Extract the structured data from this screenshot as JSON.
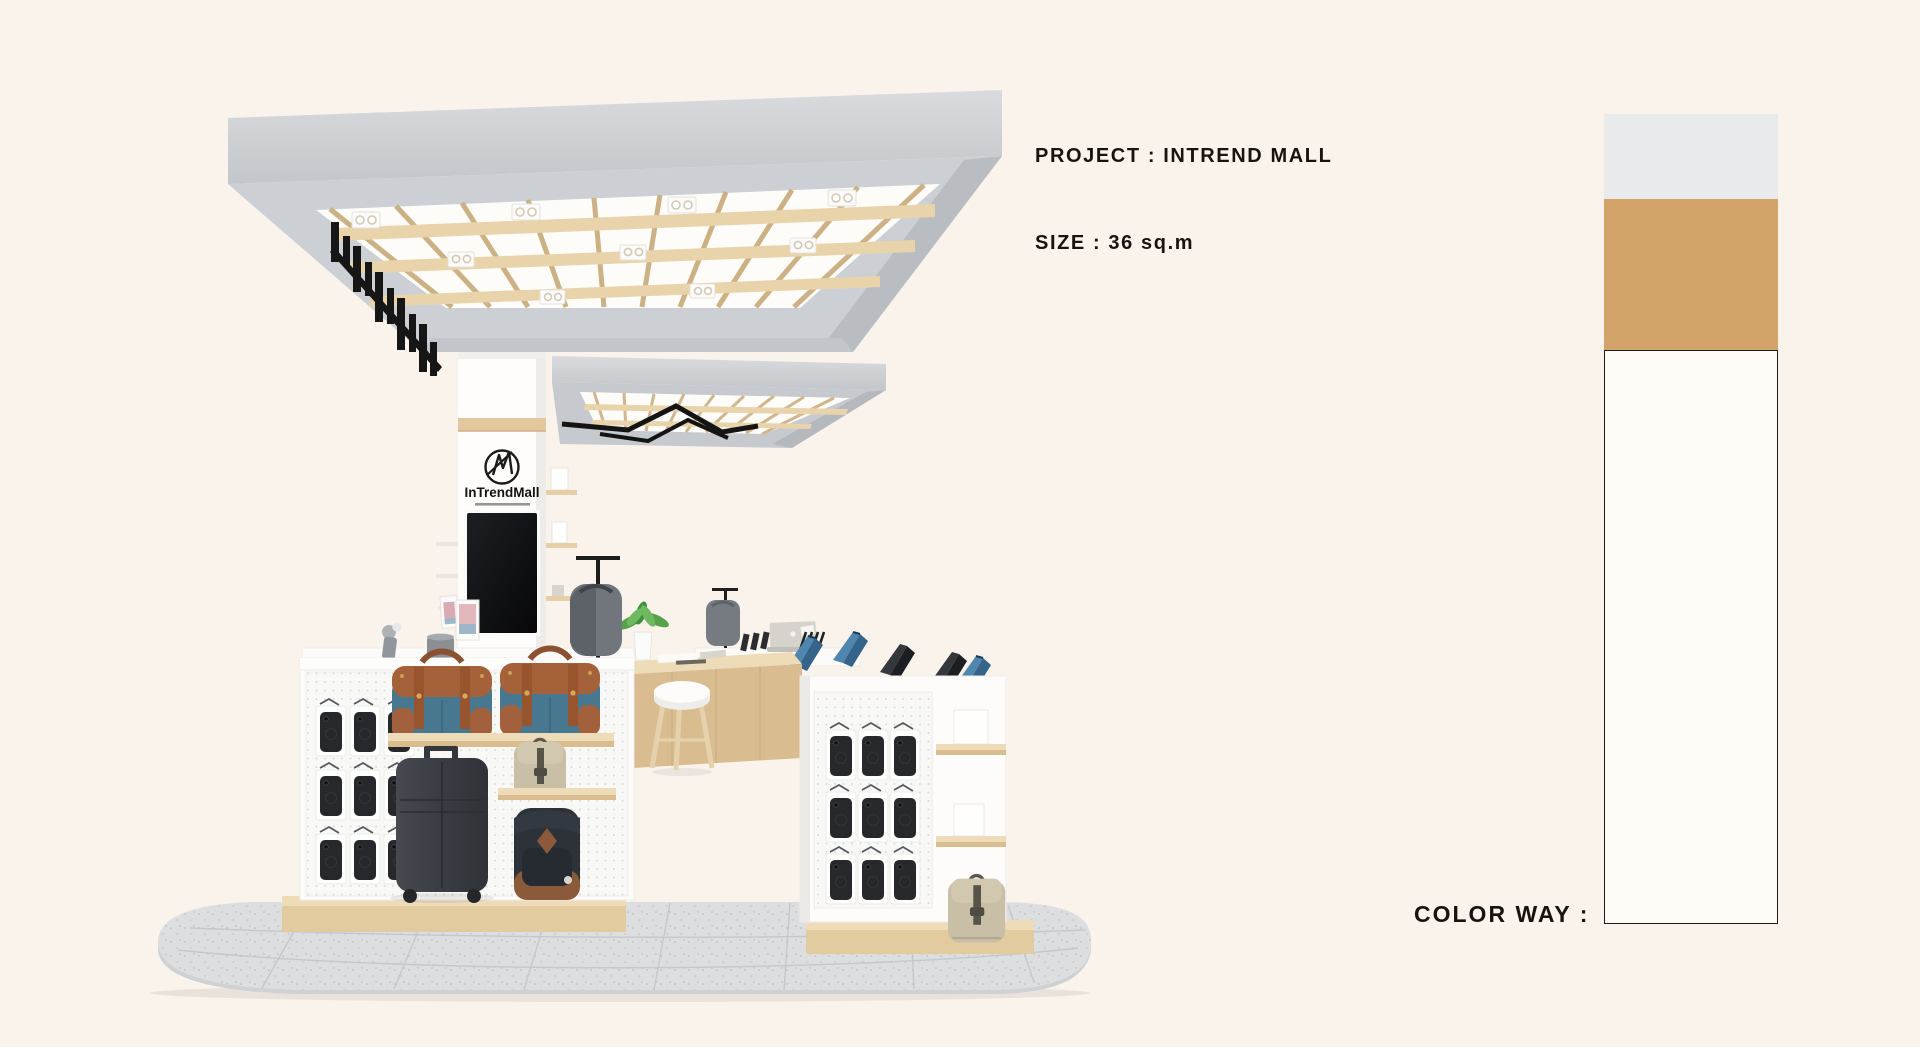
{
  "board": {
    "background": "#faf3ec",
    "text_color": "#17130f"
  },
  "annotations": {
    "project_label": "PROJECT : INTREND MALL",
    "size_label": "SIZE : 36 sq.m"
  },
  "color_way": {
    "label": "COLOR WAY :",
    "swatches": [
      {
        "name": "concrete-gray",
        "hex": "#e8eaec"
      },
      {
        "name": "camel-wood",
        "hex": "#d2a469"
      },
      {
        "name": "off-white",
        "hex": "#fffcf7"
      }
    ]
  },
  "kiosk": {
    "brand": "InTrendMall",
    "items": [
      "concrete-canopy-with-wood-slat-grid",
      "spotlight-fixtures",
      "hanging-black-sign",
      "secondary-canopy-with-zigzag-pendant-light",
      "brand-column-with-logo",
      "portrait-display-screen",
      "pegboard-phone-walls",
      "wood-shelf-with-duffel-bags",
      "suitcase",
      "khaki-backpacks",
      "navy-backpack",
      "device-counters-with-tablets-and-laptop",
      "stool",
      "potted-plant",
      "rounded-tile-floor-platform"
    ]
  }
}
